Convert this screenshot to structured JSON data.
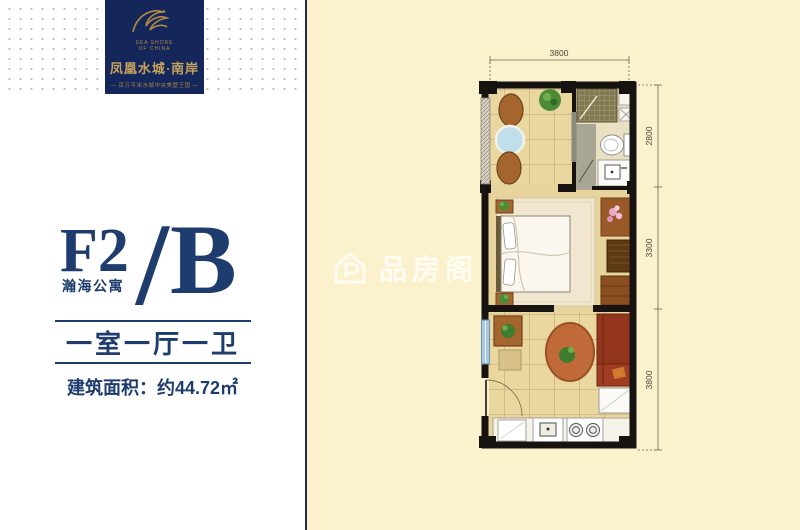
{
  "page": {
    "bg_left": "#ffffff",
    "bg_right": "#fcf1cd",
    "divider_color": "#1b2a4a",
    "navy": "#1e3c6e"
  },
  "logo": {
    "en_line1": "SEA SHORE",
    "en_line2": "OF CHINA",
    "cn_title": "凤凰水城·南岸",
    "tagline": "— 百万平米水城中央美墅王国 —",
    "bg": "#15265a",
    "gold": "#c6a45c"
  },
  "unit": {
    "code": "F2",
    "separator": "/",
    "variant": "B",
    "building": "瀚海公寓",
    "rooms": "一室一厅一卫",
    "area": "建筑面积：约44.72㎡"
  },
  "floorplan": {
    "dim_top": "3800",
    "dim_right_top": "2800",
    "dim_right_mid": "3300",
    "dim_right_bottom": "3800",
    "watermark": "品房阁",
    "wall_color": "#161310",
    "floor_color": "#ead7a0"
  }
}
